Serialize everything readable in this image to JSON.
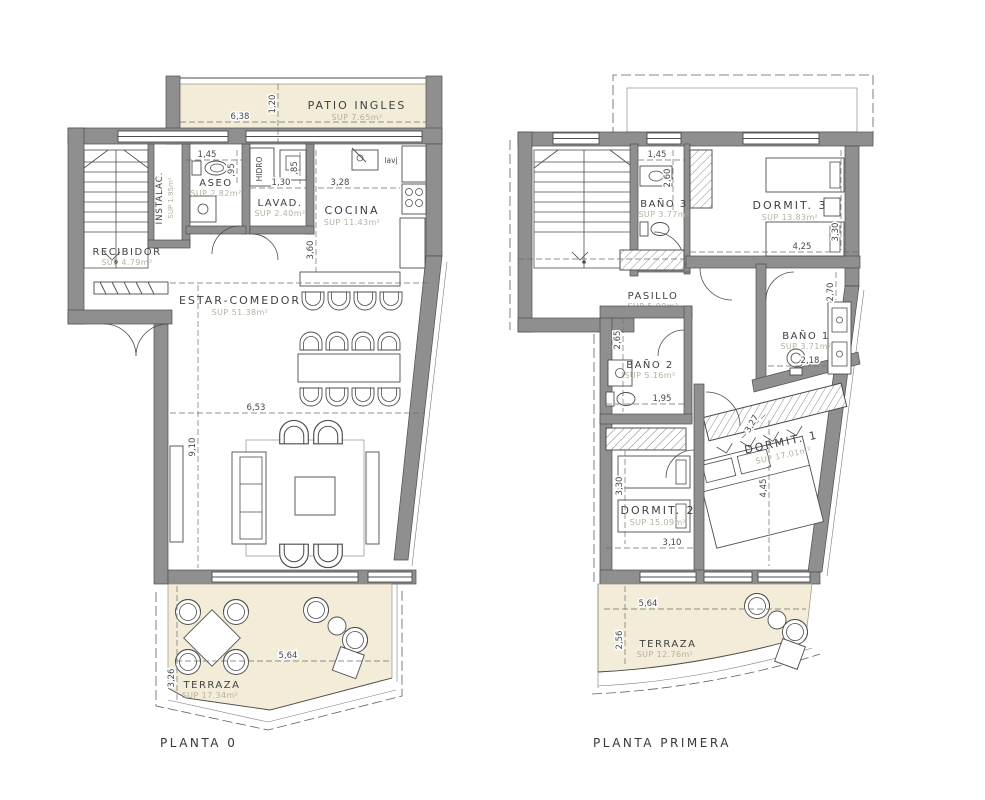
{
  "p0": {
    "label": "PLANTA 0",
    "rooms": {
      "patio": {
        "name": "PATIO INGLES",
        "sup": "SUP 7.65m²"
      },
      "aseo": {
        "name": "ASEO",
        "sup": "SUP 2.82m²"
      },
      "lavad": {
        "name": "LAVAD.",
        "sup": "SUP 2.40m²"
      },
      "cocina": {
        "name": "COCINA",
        "sup": "SUP 11.43m²"
      },
      "recibidor": {
        "name": "RECIBIDOR",
        "sup": "SUP 4.79m²"
      },
      "instalac": {
        "name": "INSTALAC.",
        "sup": "SUP 1.95m²"
      },
      "estar": {
        "name": "ESTAR-COMEDOR",
        "sup": "SUP 51.38m²"
      },
      "terraza": {
        "name": "TERRAZA",
        "sup": "SUP 17.34m²"
      }
    },
    "dims": {
      "patio_w": "6,38",
      "patio_h": "1,20",
      "aseo_w": "1,45",
      "aseo_h": ",95",
      "lavad_w": "1,30",
      "lavad_h": ",85",
      "cocina_w": "3,28",
      "cocina_h": "3,60",
      "estar_w": "6,53",
      "estar_h": "9,10",
      "terraza_w": "5,64",
      "terraza_h": "3,26"
    },
    "annotations": {
      "lavj": "lavj",
      "hidro": "HIDRO"
    }
  },
  "p1": {
    "label": "PLANTA PRIMERA",
    "rooms": {
      "banyo3": {
        "name": "BAÑO 3",
        "sup": "SUP 3.77m²"
      },
      "dormit3": {
        "name": "DORMIT. 3",
        "sup": "SUP 13.83m²"
      },
      "pasillo": {
        "name": "PASILLO",
        "sup": "SUP 5.90m²"
      },
      "banyo2": {
        "name": "BAÑO 2",
        "sup": "SUP 5.16m²"
      },
      "banyo1": {
        "name": "BAÑO 1",
        "sup": "SUP 3.71m²"
      },
      "dormit1": {
        "name": "DORMIT. 1",
        "sup": "SUP 17.01m²"
      },
      "dormit2": {
        "name": "DORMIT. 2",
        "sup": "SUP 15.09m²"
      },
      "terraza": {
        "name": "TERRAZA",
        "sup": "SUP 12.76m²"
      }
    },
    "dims": {
      "banyo3_w": "1,45",
      "banyo3_h": "2,60",
      "dormit3_w": "4,25",
      "dormit3_h": "3,30",
      "banyo1_h": "2,70",
      "banyo1_w": "2,18",
      "banyo2_h": "2,65",
      "banyo2_w": "1,95",
      "dormit2_h": "3,30",
      "dormit2_w": "3,10",
      "dormit1_h": "4,45",
      "dormit1_w": "3,27",
      "terraza_w": "5,64",
      "terraza_h": "2,56"
    }
  },
  "colors": {
    "wall": "#8f8f8f",
    "cream": "#f2ecd8",
    "line": "#4d4d4d",
    "sup_text": "#b5b09e"
  }
}
